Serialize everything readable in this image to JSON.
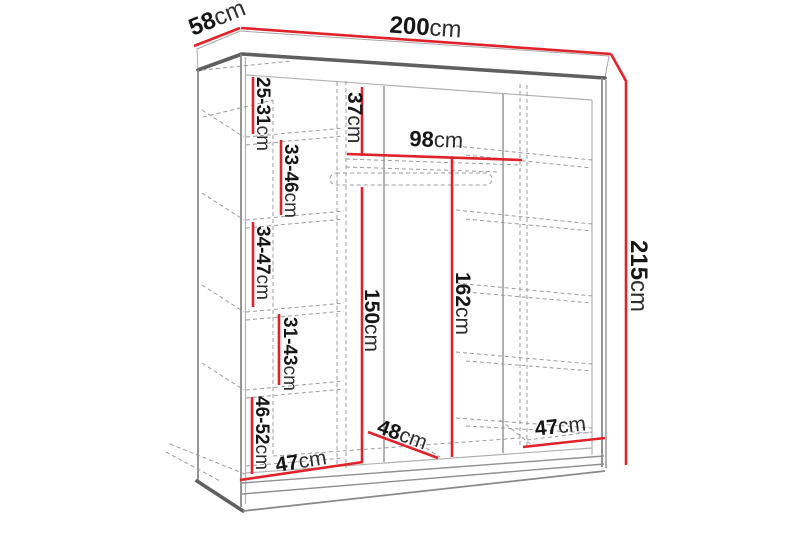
{
  "figure": {
    "kind": "wardrobe-dimension-diagram",
    "sections": 3,
    "colors": {
      "dimension_line": "#e0222a",
      "outline_dark": "#5f5f5f",
      "outline_light": "#b2b2b2",
      "hidden_line": "#9c9c9c",
      "text": "#161616",
      "background": "#ffffff"
    }
  },
  "labels": {
    "depth": {
      "value": "58",
      "unit": "cm"
    },
    "width": {
      "value": "200",
      "unit": "cm"
    },
    "height": {
      "value": "215",
      "unit": "cm"
    },
    "top_shelf_drop": {
      "value": "37",
      "unit": "cm"
    },
    "hanging_width": {
      "value": "98",
      "unit": "cm"
    },
    "hanging_height": {
      "value": "150",
      "unit": "cm"
    },
    "middle_inner_height": {
      "value": "162",
      "unit": "cm"
    },
    "left_shelves": [
      {
        "value": "25-31",
        "unit": "cm"
      },
      {
        "value": "33-46",
        "unit": "cm"
      },
      {
        "value": "34-47",
        "unit": "cm"
      },
      {
        "value": "31-43",
        "unit": "cm"
      },
      {
        "value": "46-52",
        "unit": "cm"
      }
    ],
    "section_widths": [
      {
        "value": "47",
        "unit": "cm"
      },
      {
        "value": "48",
        "unit": "cm"
      },
      {
        "value": "47",
        "unit": "cm"
      }
    ]
  }
}
